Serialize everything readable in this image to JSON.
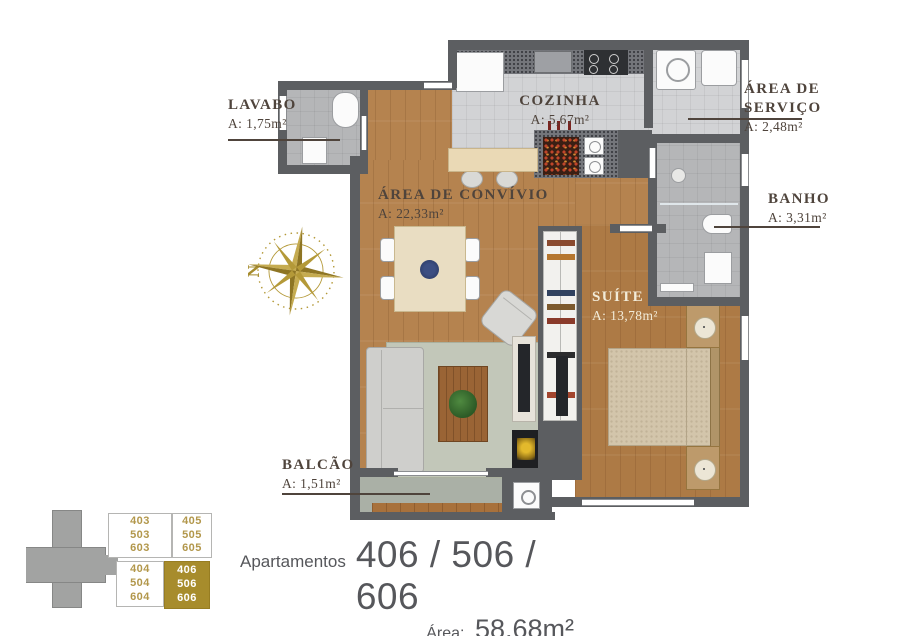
{
  "floorplan": {
    "rooms": {
      "lavabo": {
        "name": "LAVABO",
        "area": "A: 1,75m²"
      },
      "cozinha": {
        "name": "COZINHA",
        "area": "A: 5,67m²"
      },
      "servico": {
        "name": "ÁREA DE SERVIÇO",
        "area": "A: 2,48m²"
      },
      "banho": {
        "name": "BANHO",
        "area": "A: 3,31m²"
      },
      "convivio": {
        "name": "ÁREA DE CONVÍVIO",
        "area": "A: 22,33m²"
      },
      "suite": {
        "name": "SUÍTE",
        "area": "A: 13,78m²"
      },
      "balcao": {
        "name": "BALCÃO",
        "area": "A: 1,51m²"
      }
    },
    "compass": {
      "north_label": "N"
    }
  },
  "key_plan": {
    "units": [
      {
        "lines": "403\n503\n603",
        "highlighted": false
      },
      {
        "lines": "405\n505\n605",
        "highlighted": false
      },
      {
        "lines": "404\n504\n604",
        "highlighted": false
      },
      {
        "lines": "406\n506\n606",
        "highlighted": true
      }
    ]
  },
  "footer": {
    "prefix": "Apartamentos",
    "numbers": "406 / 506 / 606",
    "area_label": "Área:",
    "area_value": "58,68m²"
  },
  "colors": {
    "wall": "#5c5e61",
    "wood_floor": "#b5834f",
    "gold_accent": "#b2974b",
    "highlight_unit": "#a78c2c",
    "label_text": "#4f443c"
  }
}
